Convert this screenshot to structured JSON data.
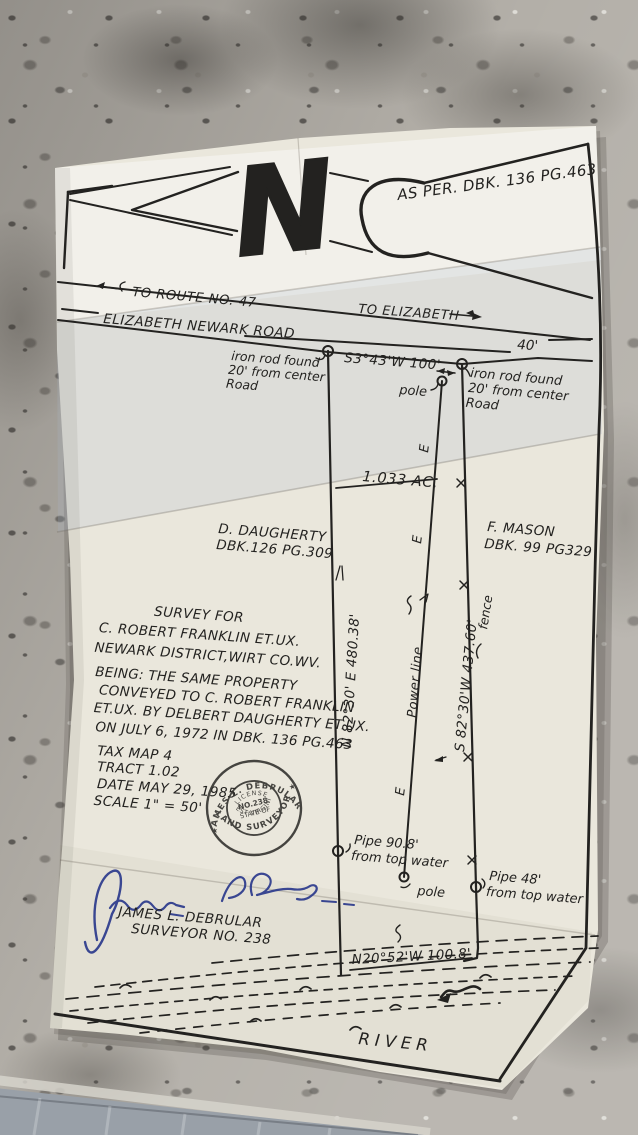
{
  "photo": {
    "surface": "granite countertop with folded paper survey plat",
    "colors": {
      "paper": "#eae7dc",
      "ink": "#232220",
      "signature_ink": "#2b3a8c",
      "granite_base": "#b3afa8",
      "floor": "#99a0a8"
    }
  },
  "plat": {
    "north_letter": "N",
    "deed_note": "AS PER. DBK. 136 PG.463",
    "road": {
      "route_direction": "TO ROUTE NO. 47",
      "town_direction": "TO ELIZABETH",
      "name": "ELIZABETH NEWARK ROAD",
      "width": "40'"
    },
    "corners": {
      "iron_rod_left": [
        "iron rod found",
        "20' from center",
        "Road"
      ],
      "iron_rod_right": [
        "iron rod found",
        "20' from center",
        "Road"
      ],
      "pipe_left": [
        "Pipe 90.8'",
        "from top water"
      ],
      "pipe_right": [
        "Pipe 48'",
        "from top water"
      ],
      "pole_top": "pole",
      "pole_bottom": "pole"
    },
    "bearings": {
      "north": "S3°43'W 100'",
      "west": "N 82°30' E 480.38'",
      "east": "S 82°30'W 437.60'",
      "south": "N20°52'W 100.8'"
    },
    "area": "1.033 AC.",
    "power_line": "Power line",
    "power_marks": "E",
    "fence": "fence",
    "adjoiner_west": [
      "D. DAUGHERTY",
      "DBK.126 PG.309"
    ],
    "adjoiner_east": [
      "F. MASON",
      "DBK. 99 PG329"
    ],
    "title_block": [
      "SURVEY FOR",
      "C. ROBERT FRANKLIN ET.UX.",
      "NEWARK DISTRICT,WIRT CO.WV."
    ],
    "deed_block": [
      "BEING: THE SAME PROPERTY",
      "CONVEYED TO C. ROBERT FRANKLIN",
      "ET.UX. BY DELBERT DAUGHERTY ET.UX.",
      "ON JULY 6, 1972 IN DBK. 136 PG.463"
    ],
    "detail_block": [
      "TAX MAP 4",
      "TRACT 1.02",
      "DATE MAY 29, 1985",
      "SCALE 1\" = 50'"
    ],
    "stamp": {
      "name": "JAMES L. DEBRULAR",
      "profession": "LAND SURVEYOR",
      "license_line1": "LICENSE",
      "license_line2": "NO.238",
      "license_line3": "STATE OF",
      "state": "WEST VIRGINIA",
      "star": "★"
    },
    "surveyor_name": "JAMES L. DEBRULAR",
    "surveyor_no": "SURVEYOR NO. 238",
    "river": "RIVER"
  }
}
